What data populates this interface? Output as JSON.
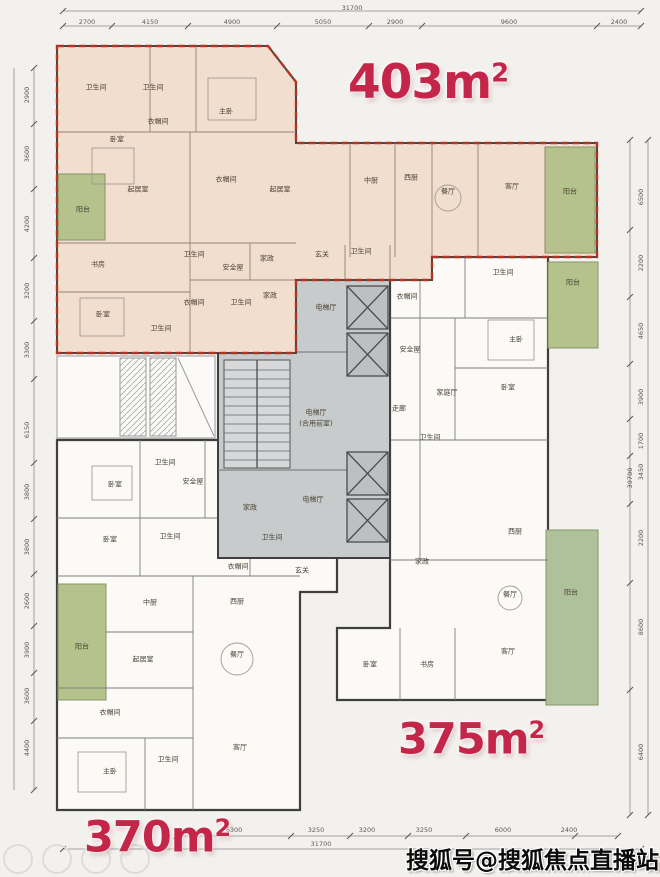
{
  "watermark": "搜狐号@搜狐焦点直播站",
  "units": {
    "a403": {
      "num": "403m",
      "sup": "2"
    },
    "a375": {
      "num": "375m",
      "sup": "2"
    },
    "a370": {
      "num": "370m",
      "sup": "2"
    }
  },
  "room_labels": [
    {
      "t": "卫生间",
      "x": 96,
      "y": 88
    },
    {
      "t": "卫生间",
      "x": 153,
      "y": 88
    },
    {
      "t": "主卧",
      "x": 226,
      "y": 112
    },
    {
      "t": "衣帽间",
      "x": 158,
      "y": 122
    },
    {
      "t": "卧室",
      "x": 117,
      "y": 140
    },
    {
      "t": "起居室",
      "x": 138,
      "y": 190
    },
    {
      "t": "阳台",
      "x": 83,
      "y": 210
    },
    {
      "t": "衣帽间",
      "x": 226,
      "y": 180
    },
    {
      "t": "起居室",
      "x": 280,
      "y": 190
    },
    {
      "t": "中厨",
      "x": 371,
      "y": 181
    },
    {
      "t": "西厨",
      "x": 411,
      "y": 178
    },
    {
      "t": "餐厅",
      "x": 448,
      "y": 192
    },
    {
      "t": "客厅",
      "x": 512,
      "y": 187
    },
    {
      "t": "阳台",
      "x": 570,
      "y": 192
    },
    {
      "t": "书房",
      "x": 98,
      "y": 265
    },
    {
      "t": "卫生间",
      "x": 194,
      "y": 255
    },
    {
      "t": "安全屋",
      "x": 233,
      "y": 268
    },
    {
      "t": "家政",
      "x": 267,
      "y": 259
    },
    {
      "t": "玄关",
      "x": 322,
      "y": 255
    },
    {
      "t": "卫生间",
      "x": 361,
      "y": 252
    },
    {
      "t": "卧室",
      "x": 103,
      "y": 315
    },
    {
      "t": "衣帽间",
      "x": 194,
      "y": 303
    },
    {
      "t": "卫生间",
      "x": 161,
      "y": 329
    },
    {
      "t": "卫生间",
      "x": 241,
      "y": 303
    },
    {
      "t": "家政",
      "x": 270,
      "y": 296
    },
    {
      "t": "电梯厅",
      "x": 326,
      "y": 308
    },
    {
      "t": "电梯厅",
      "x": 316,
      "y": 413
    },
    {
      "t": "(合用前室)",
      "x": 316,
      "y": 424
    },
    {
      "t": "电梯厅",
      "x": 313,
      "y": 500
    },
    {
      "t": "走廊",
      "x": 399,
      "y": 409
    },
    {
      "t": "衣帽间",
      "x": 407,
      "y": 297
    },
    {
      "t": "安全屋",
      "x": 410,
      "y": 350
    },
    {
      "t": "卫生间",
      "x": 503,
      "y": 273
    },
    {
      "t": "主卧",
      "x": 516,
      "y": 340
    },
    {
      "t": "卧室",
      "x": 508,
      "y": 388
    },
    {
      "t": "家庭厅",
      "x": 447,
      "y": 393
    },
    {
      "t": "阳台",
      "x": 573,
      "y": 283
    },
    {
      "t": "卫生间",
      "x": 430,
      "y": 438
    },
    {
      "t": "家政",
      "x": 422,
      "y": 562
    },
    {
      "t": "西厨",
      "x": 515,
      "y": 532
    },
    {
      "t": "餐厅",
      "x": 510,
      "y": 595
    },
    {
      "t": "客厅",
      "x": 508,
      "y": 652
    },
    {
      "t": "阳台",
      "x": 571,
      "y": 593
    },
    {
      "t": "卧室",
      "x": 370,
      "y": 665
    },
    {
      "t": "书房",
      "x": 427,
      "y": 665
    },
    {
      "t": "玄关",
      "x": 302,
      "y": 571
    },
    {
      "t": "卧室",
      "x": 115,
      "y": 485
    },
    {
      "t": "卫生间",
      "x": 165,
      "y": 463
    },
    {
      "t": "安全屋",
      "x": 193,
      "y": 482
    },
    {
      "t": "家政",
      "x": 250,
      "y": 508
    },
    {
      "t": "卧室",
      "x": 110,
      "y": 540
    },
    {
      "t": "卫生间",
      "x": 170,
      "y": 537
    },
    {
      "t": "卫生间",
      "x": 272,
      "y": 538
    },
    {
      "t": "衣帽间",
      "x": 238,
      "y": 567
    },
    {
      "t": "西厨",
      "x": 237,
      "y": 602
    },
    {
      "t": "中厨",
      "x": 150,
      "y": 603
    },
    {
      "t": "阳台",
      "x": 82,
      "y": 647
    },
    {
      "t": "起居室",
      "x": 143,
      "y": 660
    },
    {
      "t": "餐厅",
      "x": 237,
      "y": 655
    },
    {
      "t": "衣帽间",
      "x": 110,
      "y": 713
    },
    {
      "t": "主卧",
      "x": 110,
      "y": 772
    },
    {
      "t": "卫生间",
      "x": 168,
      "y": 760
    },
    {
      "t": "客厅",
      "x": 240,
      "y": 748
    }
  ],
  "dim_labels": [
    {
      "t": "31700",
      "x": 352,
      "y": 8,
      "rot": 0
    },
    {
      "t": "2700",
      "x": 87,
      "y": 22,
      "rot": 0
    },
    {
      "t": "4150",
      "x": 150,
      "y": 22,
      "rot": 0
    },
    {
      "t": "4900",
      "x": 232,
      "y": 22,
      "rot": 0
    },
    {
      "t": "5050",
      "x": 323,
      "y": 22,
      "rot": 0
    },
    {
      "t": "2900",
      "x": 395,
      "y": 22,
      "rot": 0
    },
    {
      "t": "9600",
      "x": 509,
      "y": 22,
      "rot": 0
    },
    {
      "t": "2400",
      "x": 619,
      "y": 22,
      "rot": 0
    },
    {
      "t": "6300",
      "x": 234,
      "y": 830,
      "rot": 0
    },
    {
      "t": "3250",
      "x": 316,
      "y": 830,
      "rot": 0
    },
    {
      "t": "3200",
      "x": 367,
      "y": 830,
      "rot": 0
    },
    {
      "t": "3250",
      "x": 424,
      "y": 830,
      "rot": 0
    },
    {
      "t": "6000",
      "x": 503,
      "y": 830,
      "rot": 0
    },
    {
      "t": "2400",
      "x": 569,
      "y": 830,
      "rot": 0
    },
    {
      "t": "31700",
      "x": 321,
      "y": 844,
      "rot": 0
    },
    {
      "t": "2900",
      "x": 27,
      "y": 95,
      "rot": 90
    },
    {
      "t": "3600",
      "x": 27,
      "y": 154,
      "rot": 90
    },
    {
      "t": "4200",
      "x": 27,
      "y": 224,
      "rot": 90
    },
    {
      "t": "3200",
      "x": 27,
      "y": 291,
      "rot": 90
    },
    {
      "t": "3300",
      "x": 27,
      "y": 350,
      "rot": 90
    },
    {
      "t": "6150",
      "x": 27,
      "y": 430,
      "rot": 90
    },
    {
      "t": "3800",
      "x": 27,
      "y": 492,
      "rot": 90
    },
    {
      "t": "3800",
      "x": 27,
      "y": 547,
      "rot": 90
    },
    {
      "t": "2600",
      "x": 27,
      "y": 601,
      "rot": 90
    },
    {
      "t": "3900",
      "x": 27,
      "y": 650,
      "rot": 90
    },
    {
      "t": "3600",
      "x": 27,
      "y": 696,
      "rot": 90
    },
    {
      "t": "4400",
      "x": 27,
      "y": 748,
      "rot": 90
    },
    {
      "t": "6500",
      "x": 641,
      "y": 197,
      "rot": 90
    },
    {
      "t": "2200",
      "x": 641,
      "y": 263,
      "rot": 90
    },
    {
      "t": "4650",
      "x": 641,
      "y": 331,
      "rot": 90
    },
    {
      "t": "3900",
      "x": 641,
      "y": 397,
      "rot": 90
    },
    {
      "t": "1700",
      "x": 641,
      "y": 441,
      "rot": 90
    },
    {
      "t": "3450",
      "x": 641,
      "y": 472,
      "rot": 90
    },
    {
      "t": "39700",
      "x": 630,
      "y": 478,
      "rot": 90
    },
    {
      "t": "2200",
      "x": 641,
      "y": 538,
      "rot": 90
    },
    {
      "t": "8600",
      "x": 641,
      "y": 627,
      "rot": 90
    },
    {
      "t": "6400",
      "x": 641,
      "y": 752,
      "rot": 90
    }
  ]
}
